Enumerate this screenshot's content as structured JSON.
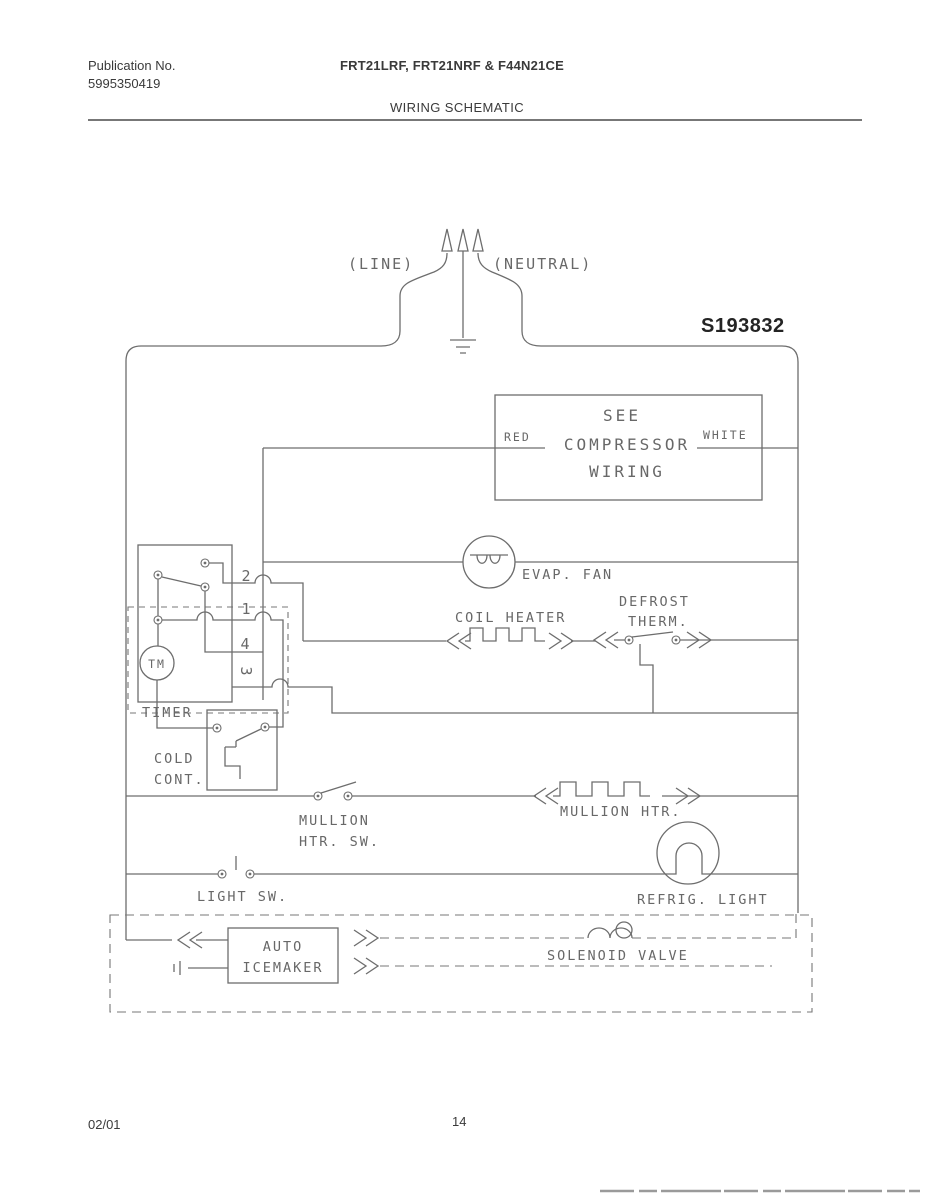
{
  "header": {
    "publication_label": "Publication No.",
    "publication_number": "5995350419",
    "models": "FRT21LRF, FRT21NRF & F44N21CE",
    "title": "WIRING SCHEMATIC"
  },
  "footer": {
    "date": "02/01",
    "page_number": "14"
  },
  "schematic": {
    "diagram_number": "S193832",
    "colors": {
      "ink": "#6d6d6d",
      "dark_ink": "#242424"
    },
    "labels": {
      "line": "(LINE)",
      "neutral": "(NEUTRAL)",
      "red": "RED",
      "white": "WHITE",
      "see": "SEE",
      "compressor": "COMPRESSOR",
      "wiring": "WIRING",
      "evap_fan": "EVAP. FAN",
      "coil_heater": "COIL HEATER",
      "defrost_line1": "DEFROST",
      "defrost_line2": "THERM.",
      "terminal_2": "2",
      "terminal_1": "1",
      "terminal_4": "4",
      "terminal_3": "3",
      "tm": "TM",
      "timer": "TIMER",
      "cold_line1": "COLD",
      "cold_line2": "CONT.",
      "mullion_sw_line1": "MULLION",
      "mullion_sw_line2": "HTR. SW.",
      "mullion_htr": "MULLION HTR.",
      "light_sw": "LIGHT SW.",
      "refrig_light": "REFRIG. LIGHT",
      "icemaker_line1": "AUTO",
      "icemaker_line2": "ICEMAKER",
      "solenoid_valve": "SOLENOID VALVE"
    }
  }
}
